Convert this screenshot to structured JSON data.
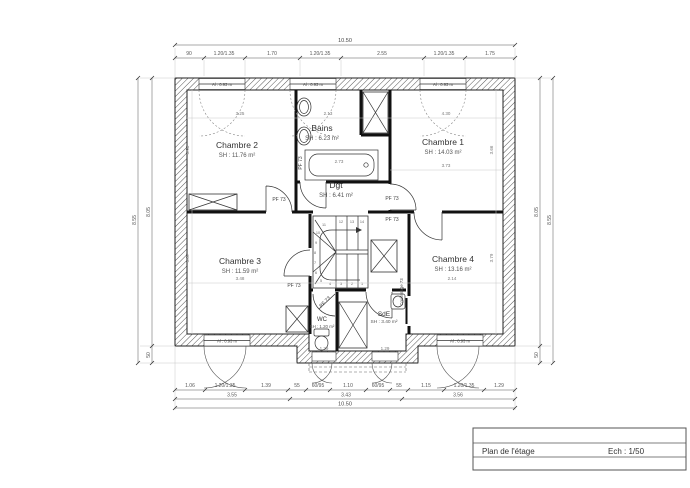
{
  "plan": {
    "rooms": [
      {
        "name": "Chambre 2",
        "area": "SH : 11.76 m²"
      },
      {
        "name": "Bains",
        "area": "SH : 6.23 m²"
      },
      {
        "name": "Chambre 1",
        "area": "SH : 14.03 m²"
      },
      {
        "name": "Dgt",
        "area": "SH : 6.41 m²"
      },
      {
        "name": "Chambre 3",
        "area": "SH : 11.59 m²"
      },
      {
        "name": "Chambre 4",
        "area": "SH : 13.16 m²"
      },
      {
        "name": "WC",
        "area": "SH : 1.20 m²"
      },
      {
        "name": "SdE",
        "area": "SH : 3.40 m²"
      }
    ],
    "door_label": "PF 73",
    "sliding_door_label": "Coulissage 73",
    "sill_label": "Al : 0.93 m",
    "stair_numbers": [
      "1",
      "2",
      "3",
      "4",
      "5",
      "6",
      "7",
      "8",
      "9",
      "10",
      "11",
      "12",
      "13",
      "14"
    ],
    "interior_dims": {
      "ch2_w": "3.25",
      "bains_w": "2.13",
      "ch1_w": "4.30",
      "ch1_w2": "3.73",
      "bath": "2.73",
      "ch3_w": "3.48",
      "ch4_w": "2.14",
      "ch2_h": "3.93",
      "ch3_h": "3.87",
      "ch1_h": "3.66",
      "ch4_h": "3.79",
      "wc_win": "1.29",
      "sde_win": "1.29"
    },
    "dims": {
      "top_overall": "10.50",
      "top": [
        "90",
        "1.20/1.35",
        "1.70",
        "1.20/1.35",
        "2.55",
        "1.20/1.35",
        "1.75"
      ],
      "bottom1": [
        "1.06",
        "1.20/1.35",
        "1.39",
        "55",
        "60/95",
        "1.10",
        "60/95",
        "55",
        "1.15",
        "1.20/1.35",
        "1.29"
      ],
      "bottom2": [
        "3.55",
        "3.43",
        "3.56"
      ],
      "bottom_overall": "10.50",
      "left_outer": "8.55",
      "left_inner": "8.05",
      "left_low": "50",
      "right_outer": "8.55",
      "right_inner": "8.05",
      "right_low": "50"
    }
  },
  "title_block": {
    "title": "Plan de l'étage",
    "scale": "Ech : 1/50"
  }
}
